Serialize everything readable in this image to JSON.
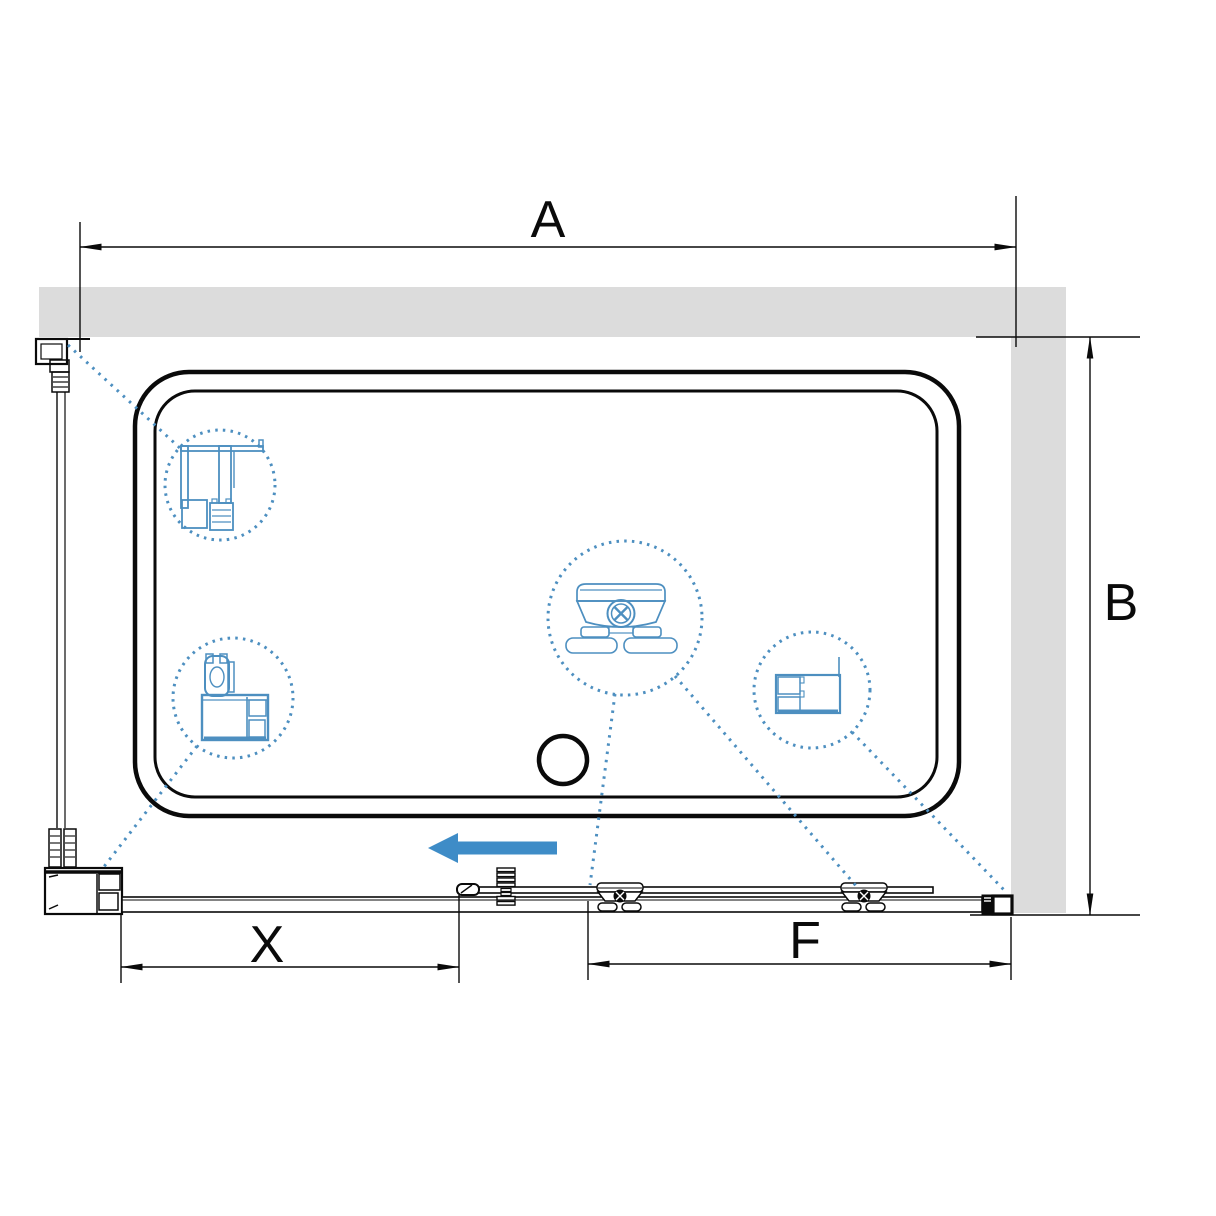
{
  "diagram": {
    "type": "technical-drawing",
    "subject": "sliding-shower-enclosure-top-view",
    "labels": {
      "width_total": "A",
      "depth": "B",
      "opening": "X",
      "fixed_panel": "F"
    },
    "slide_arrow": {
      "direction": "left"
    },
    "callouts": [
      {
        "name": "wall-profile-section-detail"
      },
      {
        "name": "corner-profile-section-detail"
      },
      {
        "name": "roller-assembly-detail"
      },
      {
        "name": "fixed-panel-profile-section-detail"
      }
    ]
  },
  "colors": {
    "wall_fill": "#dcdcdc",
    "line": "#0a0a0a",
    "accent_blue": "#3e8cc7",
    "callout_blue": "#4d8fc0",
    "background": "#ffffff"
  }
}
